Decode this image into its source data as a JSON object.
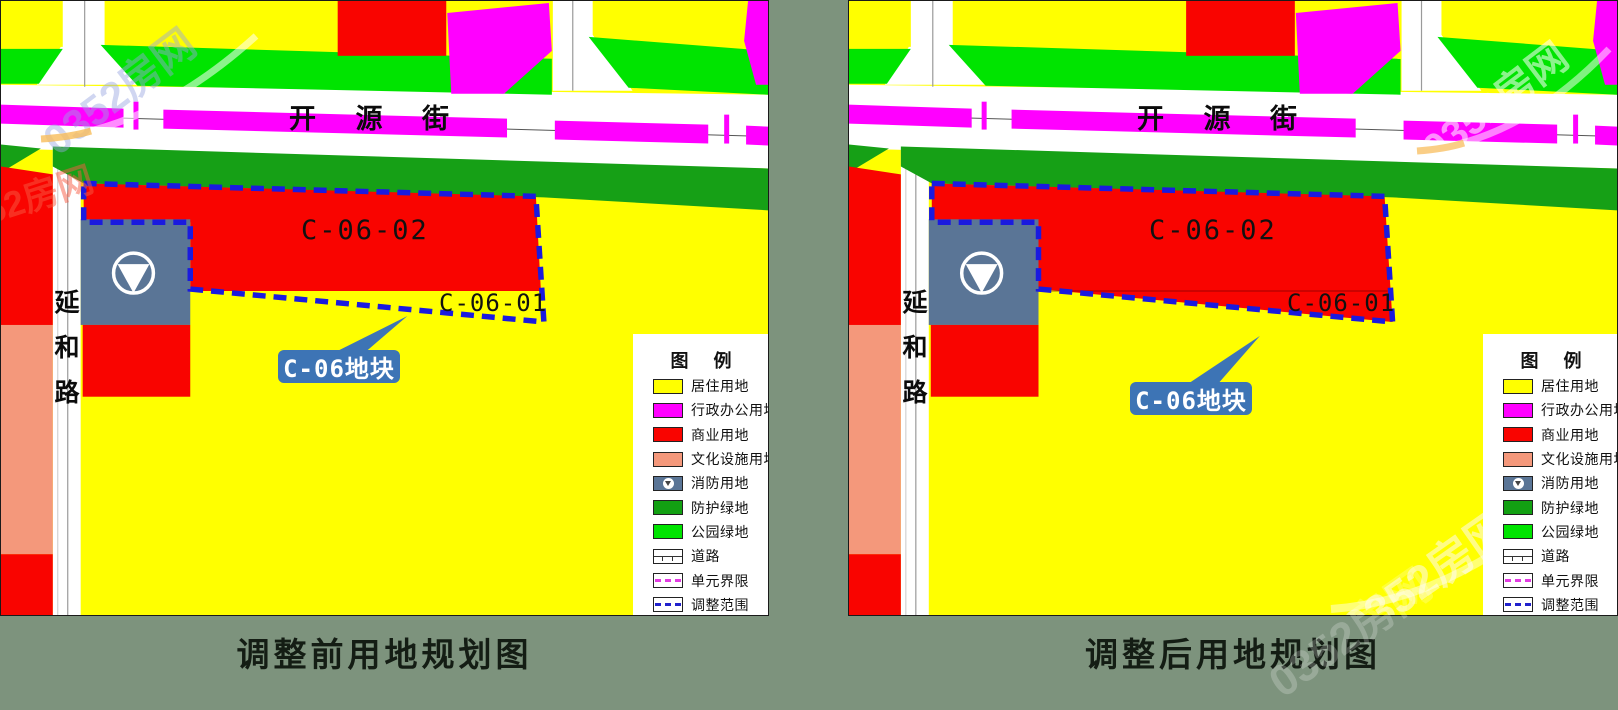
{
  "map": {
    "street_label": "开 源 街",
    "road_label": "延和路",
    "parcel_main_label": "C-06-02",
    "parcel_sub_label": "C-06-01",
    "callout_label": "C-06地块"
  },
  "legend": {
    "title": "图 例",
    "items": [
      {
        "label": "居住用地",
        "type": "residential",
        "color": "#FFFF00"
      },
      {
        "label": "行政办公用地",
        "type": "admin-office",
        "color": "#FF00FF"
      },
      {
        "label": "商业用地",
        "type": "commercial",
        "color": "#F90400"
      },
      {
        "label": "文化设施用地",
        "type": "cultural-facilities",
        "color": "#F4987B"
      },
      {
        "label": "消防用地",
        "type": "fire-service",
        "color": "#5A7596"
      },
      {
        "label": "防护绿地",
        "type": "protective-green",
        "color": "#12A012"
      },
      {
        "label": "公园绿地",
        "type": "park-green",
        "color": "#00E400"
      },
      {
        "label": "道路",
        "type": "road",
        "color": "#FFFFFF"
      },
      {
        "label": "单元界限",
        "type": "unit-boundary",
        "color": "#E23BE2"
      },
      {
        "label": "调整范围",
        "type": "adjustment-scope",
        "color": "#2222CC"
      }
    ]
  },
  "panels": {
    "before": {
      "caption": "调整前用地规划图"
    },
    "after": {
      "caption": "调整后用地规划图"
    }
  },
  "watermark": {
    "text": "0352房网"
  },
  "colors": {
    "residential_yellow": "#FFFF00",
    "admin_magenta": "#FF00FF",
    "commercial_red": "#F90400",
    "cultural_salmon": "#F4987B",
    "fire_blue_gray": "#5A7596",
    "protective_green": "#16A016",
    "park_green": "#00E400",
    "road_white": "#FFFFFF",
    "boundary_blue": "#1A1ADF",
    "callout_blue": "#3D74B5",
    "background_sage": "#7D937D"
  }
}
